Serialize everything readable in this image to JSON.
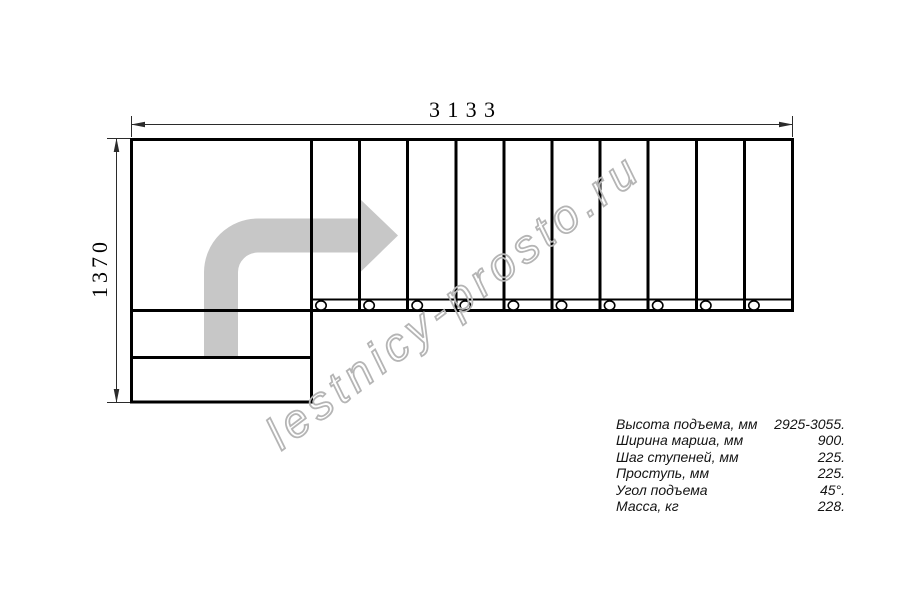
{
  "drawing": {
    "type": "staircase-plan-top-view",
    "width_dimension": "3133",
    "height_dimension": "1370",
    "tread_count": 10,
    "lower_steps": 2,
    "direction_arrow": "up-then-turn-right",
    "colors": {
      "line": "#000000",
      "dimension": "#2b2b2b",
      "arrow_fill": "#c7c7c7",
      "watermark": "#b5b5b5"
    }
  },
  "watermark": {
    "text": "lestnicy-prosto.ru"
  },
  "specs": {
    "rows": [
      {
        "label": "Высота подъема, мм",
        "value": "2925-3055."
      },
      {
        "label": "Ширина марша, мм",
        "value": "900."
      },
      {
        "label": "Шаг ступеней, мм",
        "value": "225."
      },
      {
        "label": "Проступь, мм",
        "value": "225."
      },
      {
        "label": "Угол подъема",
        "value": "45°."
      },
      {
        "label": "Масса, кг",
        "value": "228."
      }
    ]
  }
}
